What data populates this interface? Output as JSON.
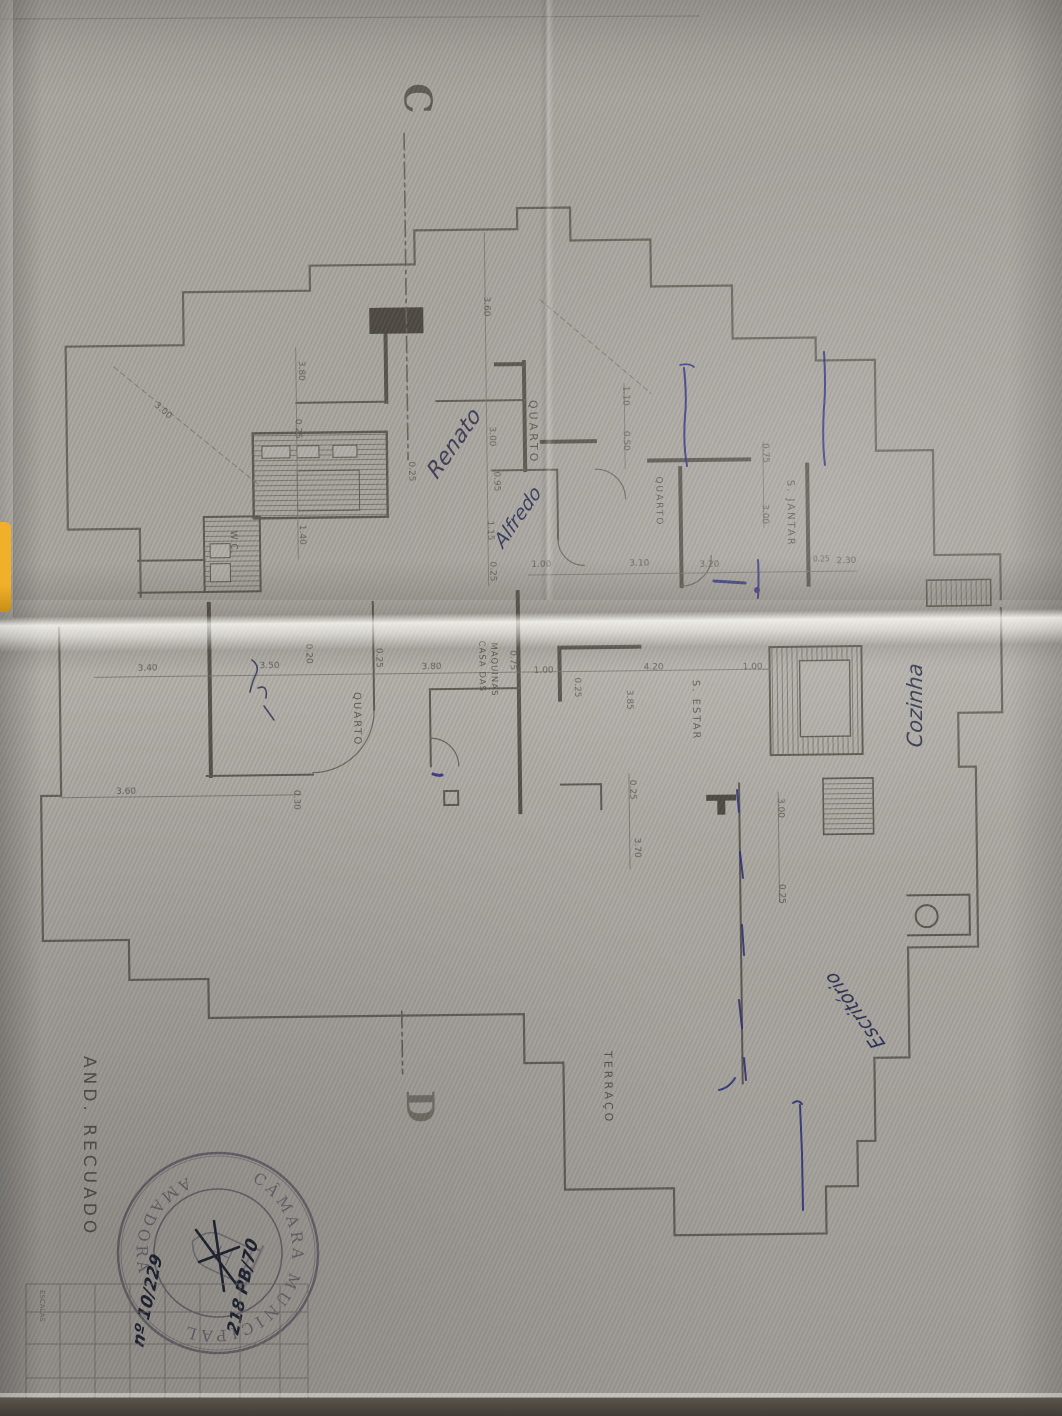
{
  "page": {
    "plan_label": "AND. RECUADO"
  },
  "section_markers": {
    "top": "C",
    "bottom": "D"
  },
  "rooms": [
    {
      "label": "QUARTO"
    },
    {
      "label": "QUARTO"
    },
    {
      "label": "S. JANTAR"
    },
    {
      "label": "W.C."
    },
    {
      "label": "QUARTO"
    },
    {
      "label": "CASA DAS"
    },
    {
      "label": "MAQUINAS"
    },
    {
      "label": "S. ESTAR"
    },
    {
      "label": "TERRAÇO"
    }
  ],
  "dims": [
    "3.00",
    "3.80",
    "0.25",
    "3.60",
    "3.00",
    "0.95",
    "0.25",
    "1.40",
    "1.15",
    "0.25",
    "1.00",
    "3.10",
    "3.20",
    "0.75",
    "3.00",
    "0.25",
    "2.30",
    "1.10",
    "0.50",
    "3.40",
    "3.50",
    "0.20",
    "0.25",
    "3.80",
    "0.75",
    "1.00",
    "4.20",
    "0.25",
    "3.85",
    "1.00",
    "3.60",
    "0.30",
    "0.25",
    "3.70",
    "3.00",
    "0.25"
  ],
  "handwriting": {
    "renato": "Renato",
    "alfredo": "Alfredo",
    "cozinha": "Cozinha",
    "escritorio": "Escritório",
    "stamp_note_1": "218 PB/70",
    "stamp_note_2": "nº 10/229"
  },
  "stamp": {
    "arc_top": "CÂMARA MUNICIPAL",
    "arc_bottom": "AMADORA"
  },
  "title_block": {
    "col_label": "ESCALAS"
  },
  "ink_color": "#2f3280",
  "pencil_color": "#6b675f"
}
